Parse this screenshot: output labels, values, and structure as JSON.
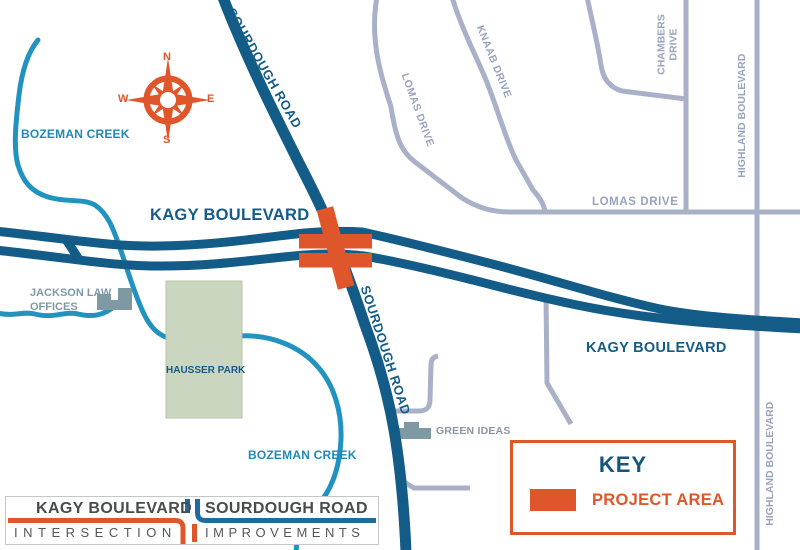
{
  "map": {
    "labels": {
      "sourdough_top": "SOURDOUGH ROAD",
      "sourdough_bottom": "SOURDOUGH ROAD",
      "bozeman_creek_top": "BOZEMAN CREEK",
      "bozeman_creek_bottom": "BOZEMAN CREEK",
      "kagy_left": "KAGY BOULEVARD",
      "kagy_right": "KAGY BOULEVARD",
      "lomas_diagonal": "LOMAS DRIVE",
      "lomas_horizontal": "LOMAS DRIVE",
      "knaab": "KNAAB DRIVE",
      "chambers_line1": "CHAMBERS",
      "chambers_line2": "DRIVE",
      "highland_top": "HIGHLAND BOULEVARD",
      "highland_bottom": "HIGHLAND BOULEVARD",
      "jackson_line1": "JACKSON LAW",
      "jackson_line2": "OFFICES",
      "hausser_park": "HAUSSER PARK",
      "green_ideas": "GREEN IDEAS"
    },
    "compass": {
      "n": "N",
      "e": "E",
      "s": "S",
      "w": "W"
    }
  },
  "key": {
    "title": "KEY",
    "project_area_label": "PROJECT AREA"
  },
  "logo": {
    "road1": "KAGY BOULEVARD",
    "road2": "SOURDOUGH ROAD",
    "word1": "INTERSECTION",
    "word2": "IMPROVEMENTS"
  },
  "colors": {
    "major_road_blue": "#135C88",
    "creek_blue": "#2293BF",
    "minor_road_gray": "#A9B1C8",
    "project_orange": "#E0562B",
    "park_green": "#CBD6C1",
    "building_gray": "#7E99A1",
    "key_title_blue": "#15567D"
  }
}
